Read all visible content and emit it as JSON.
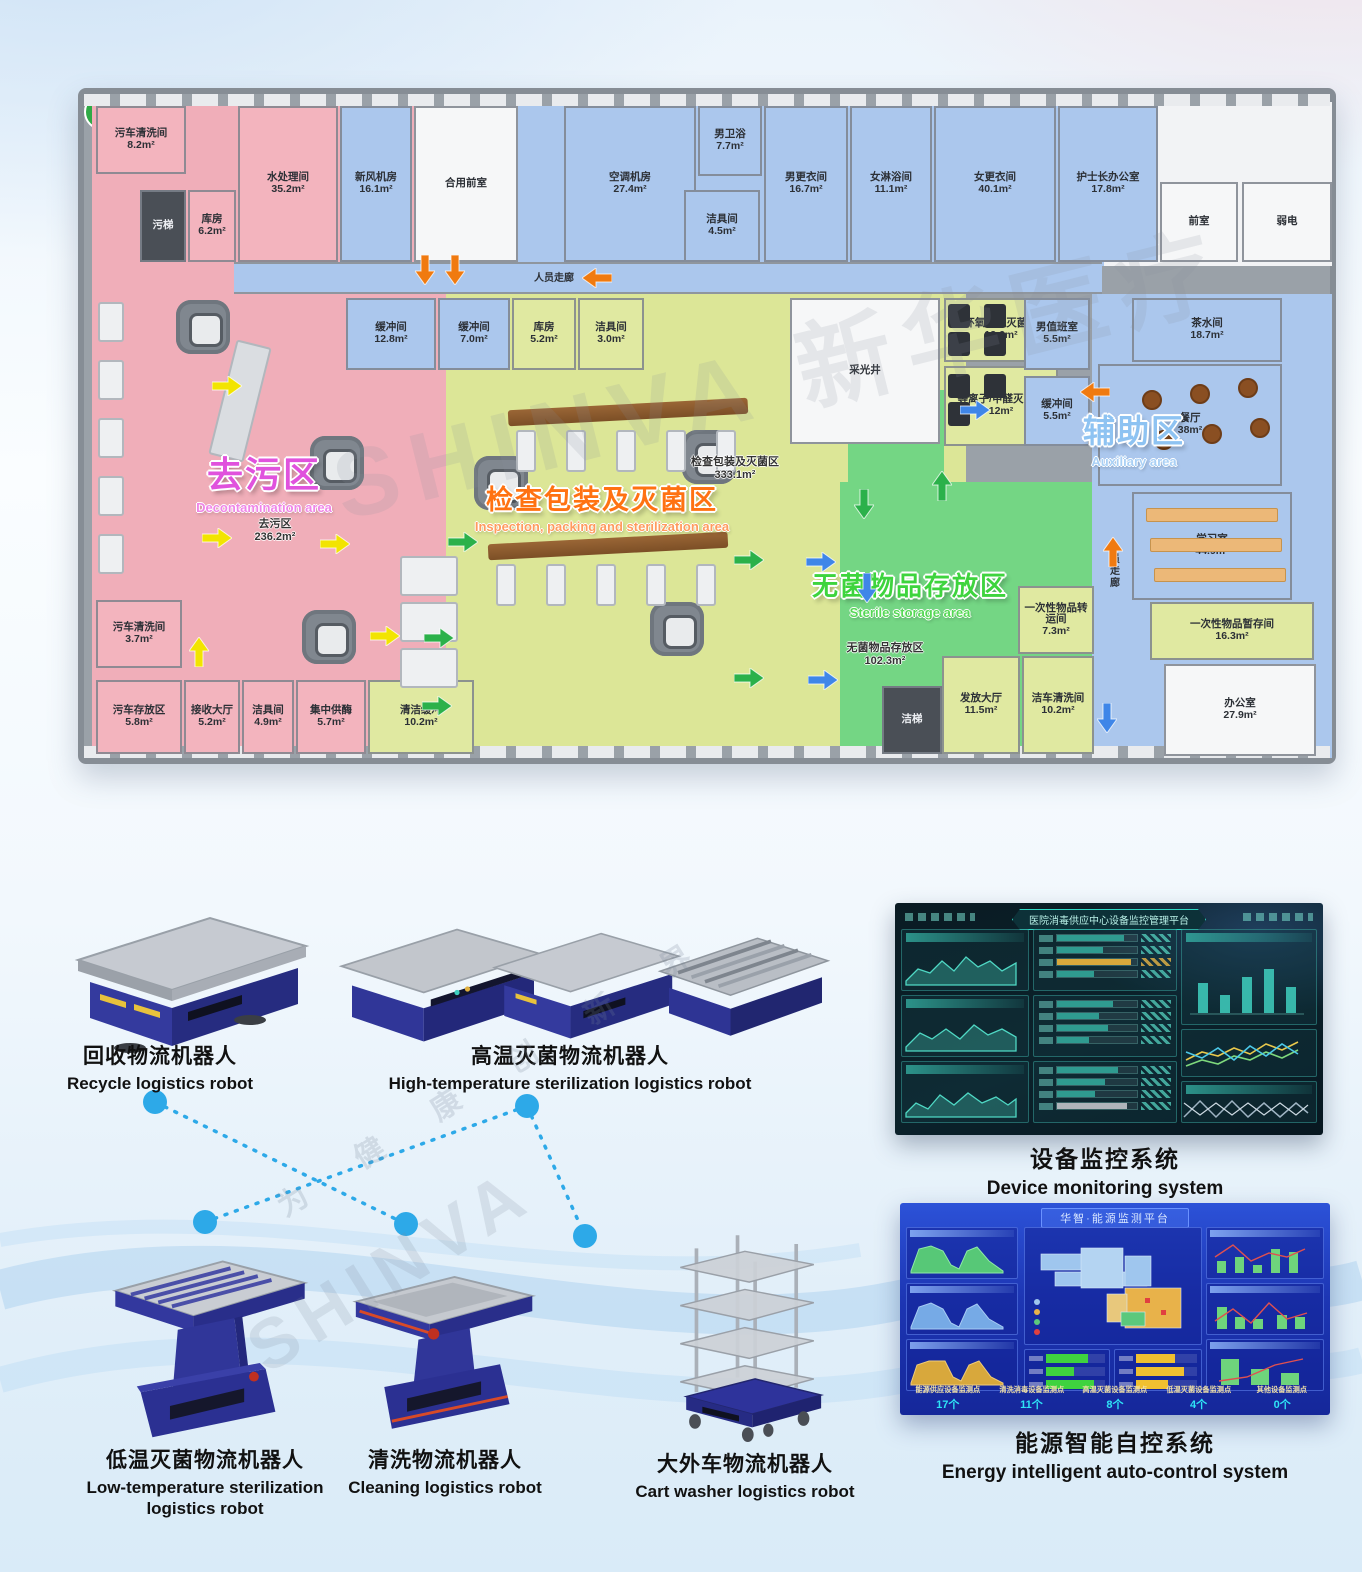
{
  "watermark": {
    "brand": "SHINVA 新华医疗",
    "brand_short": "SHINVA",
    "slogan": "为 健 康 创 新 界"
  },
  "floor_plan": {
    "zones": [
      {
        "id": "decontamination",
        "title_zh": "去污区",
        "title_en": "Decontamination area",
        "color": "#e052dd",
        "floor_label": "去污区",
        "floor_area": "236.2m²"
      },
      {
        "id": "inspection",
        "title_zh": "检查包装及灭菌区",
        "title_en": "Inspection, packing and sterilization area",
        "color": "#ff7212",
        "floor_label": "检查包装及灭菌区",
        "floor_area": "333.1m²"
      },
      {
        "id": "sterile",
        "title_zh": "无菌物品存放区",
        "title_en": "Sterile storage area",
        "color": "#3ed43e",
        "floor_label": "无菌物品存放区",
        "floor_area": "102.3m²"
      },
      {
        "id": "auxiliary",
        "title_zh": "辅助区",
        "title_en": "Auxiliary area",
        "color": "#8ec3f2"
      }
    ],
    "rooms": [
      {
        "id": "wu_che_qx_top",
        "name": "污车清洗间",
        "area": "8.2m²"
      },
      {
        "id": "wu_ti",
        "name": "污梯",
        "area": ""
      },
      {
        "id": "ku_fang_62",
        "name": "库房",
        "area": "6.2m²"
      },
      {
        "id": "shui_chu_li",
        "name": "水处理间",
        "area": "35.2m²"
      },
      {
        "id": "xin_feng_ji_fang",
        "name": "新风机房",
        "area": "16.1m²"
      },
      {
        "id": "he_yong_qian_shi",
        "name": "合用前室",
        "area": ""
      },
      {
        "id": "kong_tiao_ji_fang",
        "name": "空调机房",
        "area": "27.4m²"
      },
      {
        "id": "nan_wei_yu",
        "name": "男卫浴",
        "area": "7.7m²"
      },
      {
        "id": "jie_ju_45",
        "name": "洁具间",
        "area": "4.5m²"
      },
      {
        "id": "nan_geng_yi",
        "name": "男更衣间",
        "area": "16.7m²"
      },
      {
        "id": "nv_lin_yu",
        "name": "女淋浴间",
        "area": "11.1m²"
      },
      {
        "id": "nv_geng_yi",
        "name": "女更衣间",
        "area": "40.1m²"
      },
      {
        "id": "hu_shi_zhang",
        "name": "护士长办公室",
        "area": "17.8m²"
      },
      {
        "id": "qian_shi",
        "name": "前室",
        "area": ""
      },
      {
        "id": "ruo_dian",
        "name": "弱电",
        "area": ""
      },
      {
        "id": "huan_chong_128",
        "name": "缓冲间",
        "area": "12.8m²"
      },
      {
        "id": "huan_chong_70",
        "name": "缓冲间",
        "area": "7.0m²"
      },
      {
        "id": "ku_fang_52",
        "name": "库房",
        "area": "5.2m²"
      },
      {
        "id": "jie_ju_30",
        "name": "洁具间",
        "area": "3.0m²"
      },
      {
        "id": "cai_guang_jing",
        "name": "采光井",
        "area": ""
      },
      {
        "id": "huan_yang",
        "name": "环氧乙烷灭菌间",
        "area": "13.6m²"
      },
      {
        "id": "deng_li_zi",
        "name": "等离子/甲醛灭菌间",
        "area": "12m²"
      },
      {
        "id": "nan_zhi_ban",
        "name": "男值班室",
        "area": "5.5m²"
      },
      {
        "id": "huan_chong_55",
        "name": "缓冲间",
        "area": "5.5m²"
      },
      {
        "id": "wu_che_qx_2",
        "name": "污车清洗间",
        "area": "3.7m²"
      },
      {
        "id": "wu_che_cun",
        "name": "污车存放区",
        "area": "5.8m²"
      },
      {
        "id": "jie_shou",
        "name": "接收大厅",
        "area": "5.2m²"
      },
      {
        "id": "jie_ju_49",
        "name": "洁具间",
        "area": "4.9m²"
      },
      {
        "id": "ji_zhong",
        "name": "集中供酶",
        "area": "5.7m²"
      },
      {
        "id": "qing_jie",
        "name": "清洁缓冲",
        "area": "10.2m²"
      },
      {
        "id": "yi_ci_zhuanyun",
        "name": "一次性物品转运间",
        "area": "7.3m²"
      },
      {
        "id": "fa_fang",
        "name": "发放大厅",
        "area": "11.5m²"
      },
      {
        "id": "jie_che_qx",
        "name": "洁车清洗间",
        "area": "10.2m²"
      },
      {
        "id": "jie_ti",
        "name": "洁梯",
        "area": ""
      },
      {
        "id": "cha_shui",
        "name": "茶水间",
        "area": "18.7m²"
      },
      {
        "id": "can_ting",
        "name": "餐厅",
        "area": "38m²"
      },
      {
        "id": "xue_xi",
        "name": "学习室",
        "area": "44.9m²"
      },
      {
        "id": "yi_ci_zancun",
        "name": "一次性物品暂存间",
        "area": "16.3m²"
      },
      {
        "id": "ban_gong",
        "name": "办公室",
        "area": "27.9m²"
      },
      {
        "id": "corridor_h",
        "name": "人员走廊",
        "area": ""
      },
      {
        "id": "corridor_v",
        "name": "人员走廊",
        "area": ""
      }
    ]
  },
  "products": [
    {
      "id": "recycle",
      "name_zh": "回收物流机器人",
      "name_en": "Recycle logistics robot"
    },
    {
      "id": "high_temp",
      "name_zh": "高温灭菌物流机器人",
      "name_en": "High-temperature sterilization logistics robot"
    },
    {
      "id": "low_temp",
      "name_zh": "低温灭菌物流机器人",
      "name_en": "Low-temperature sterilization logistics robot"
    },
    {
      "id": "cleaning",
      "name_zh": "清洗物流机器人",
      "name_en": "Cleaning logistics robot"
    },
    {
      "id": "cart_washer",
      "name_zh": "大外车物流机器人",
      "name_en": "Cart washer logistics robot"
    }
  ],
  "screens": {
    "device": {
      "name_zh": "设备监控系统",
      "name_en": "Device monitoring system",
      "panel_title": "医院消毒供应中心设备监控管理平台"
    },
    "energy": {
      "name_zh": "能源智能自控系统",
      "name_en": "Energy intelligent auto-control system",
      "panel_title": "华智·能源监测平台",
      "monitor_points": [
        {
          "label": "能源供应设备监测点",
          "count": "17个"
        },
        {
          "label": "清洗消毒设备监测点",
          "count": "11个"
        },
        {
          "label": "高温灭菌设备监测点",
          "count": "8个"
        },
        {
          "label": "低温灭菌设备监测点",
          "count": "4个"
        },
        {
          "label": "其他设备监测点",
          "count": "0个"
        }
      ]
    }
  }
}
